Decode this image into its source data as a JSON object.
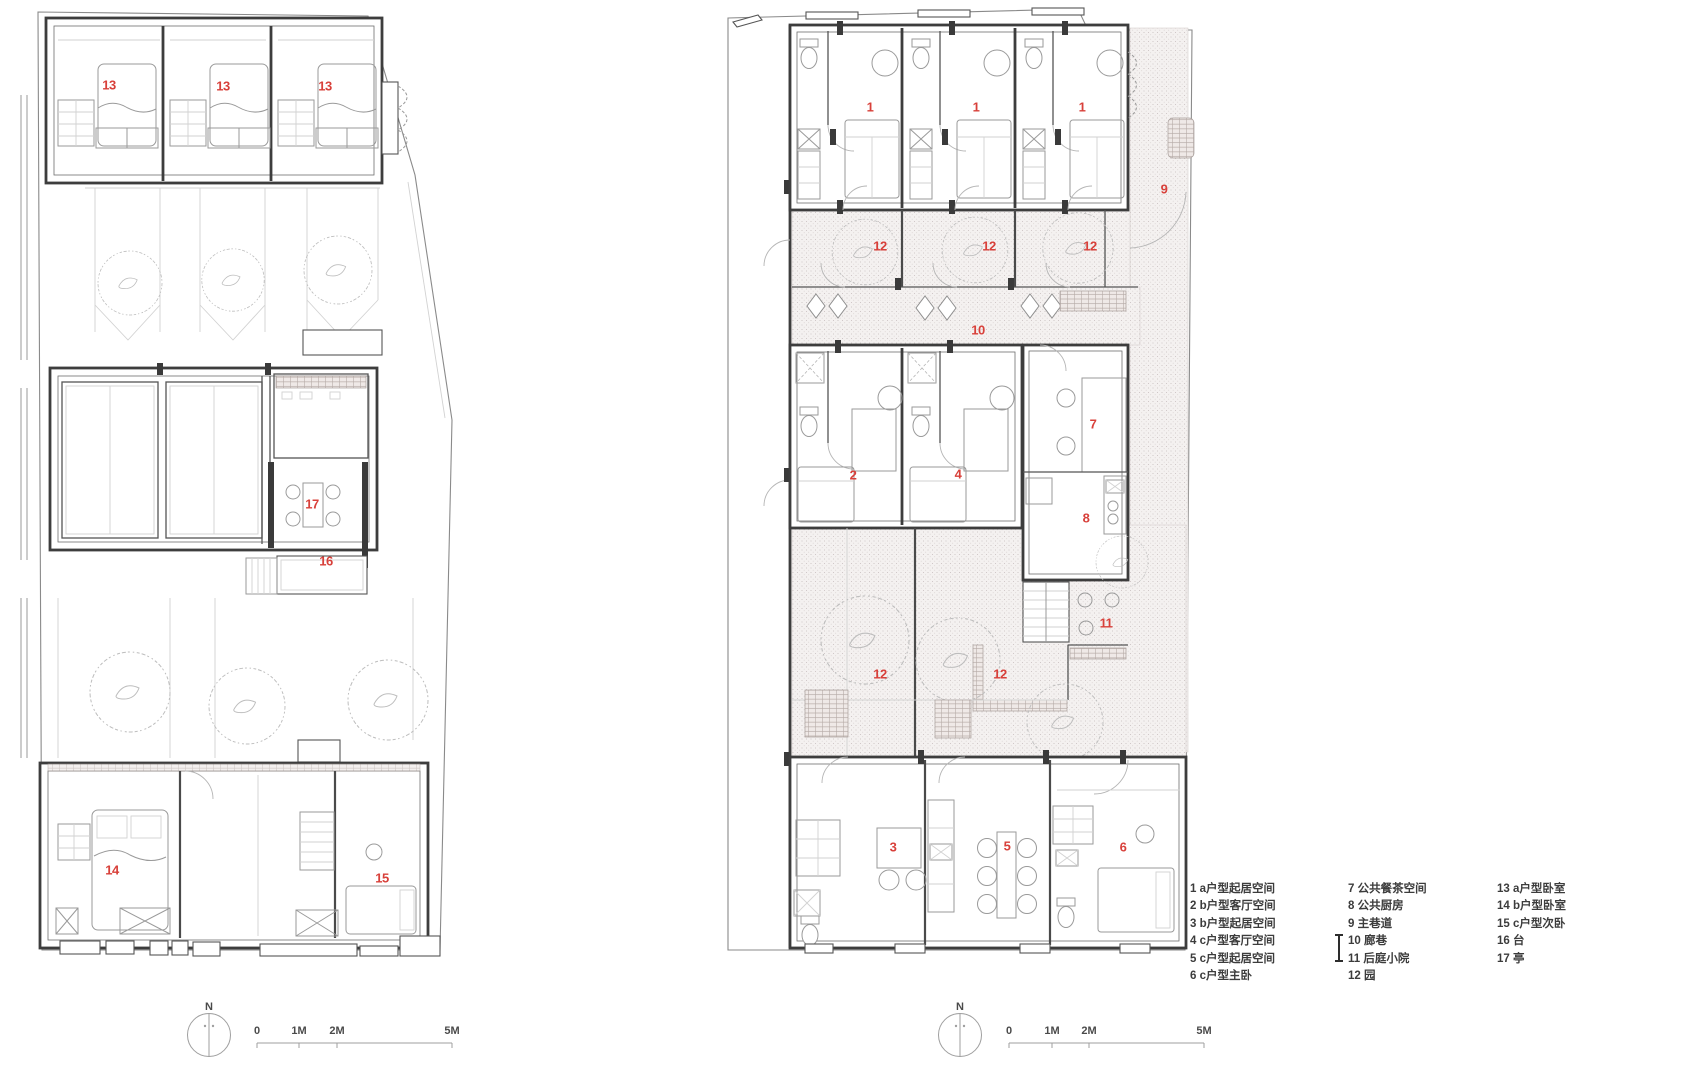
{
  "colors": {
    "label_red": "#d8403a",
    "wall_dark": "#3d3d3d",
    "line_mid": "#9a9a9a",
    "stipple_dot": "#c7bfbe",
    "anno_gray": "#4a4a4a"
  },
  "legend": {
    "columns": [
      {
        "items": [
          {
            "n": "1",
            "t": "a户型起居空间"
          },
          {
            "n": "2",
            "t": "b户型客厅空间"
          },
          {
            "n": "3",
            "t": "b户型起居空间"
          },
          {
            "n": "4",
            "t": "c户型客厅空间"
          },
          {
            "n": "5",
            "t": "c户型起居空间"
          },
          {
            "n": "6",
            "t": "c户型主卧"
          }
        ]
      },
      {
        "items": [
          {
            "n": "7",
            "t": "公共餐茶空间"
          },
          {
            "n": "8",
            "t": "公共厨房"
          },
          {
            "n": "9",
            "t": "主巷道"
          },
          {
            "n": "10",
            "t": "廊巷"
          },
          {
            "n": "11",
            "t": "后庭小院"
          },
          {
            "n": "12",
            "t": "园"
          }
        ]
      },
      {
        "items": [
          {
            "n": "13",
            "t": "a户型卧室"
          },
          {
            "n": "14",
            "t": "b户型卧室"
          },
          {
            "n": "15",
            "t": "c户型次卧"
          },
          {
            "n": "16",
            "t": "台"
          },
          {
            "n": "17",
            "t": "亭"
          }
        ]
      }
    ]
  },
  "plans": {
    "left": {
      "room_labels": [
        {
          "t": "13",
          "x": 109,
          "y": 86
        },
        {
          "t": "13",
          "x": 223,
          "y": 87
        },
        {
          "t": "13",
          "x": 325,
          "y": 87
        },
        {
          "t": "17",
          "x": 312,
          "y": 505
        },
        {
          "t": "16",
          "x": 326,
          "y": 562
        },
        {
          "t": "14",
          "x": 112,
          "y": 871
        },
        {
          "t": "15",
          "x": 382,
          "y": 879
        }
      ],
      "annotations": [
        {
          "t": "N",
          "x": 209,
          "y": 1007
        },
        {
          "t": "0",
          "x": 257,
          "y": 1031
        },
        {
          "t": "1M",
          "x": 299,
          "y": 1031
        },
        {
          "t": "2M",
          "x": 337,
          "y": 1031
        },
        {
          "t": "5M",
          "x": 452,
          "y": 1031
        }
      ]
    },
    "right": {
      "room_labels": [
        {
          "t": "1",
          "x": 870,
          "y": 108
        },
        {
          "t": "1",
          "x": 976,
          "y": 108
        },
        {
          "t": "1",
          "x": 1082,
          "y": 108
        },
        {
          "t": "9",
          "x": 1164,
          "y": 190
        },
        {
          "t": "12",
          "x": 880,
          "y": 247
        },
        {
          "t": "12",
          "x": 989,
          "y": 247
        },
        {
          "t": "12",
          "x": 1090,
          "y": 247
        },
        {
          "t": "10",
          "x": 978,
          "y": 331
        },
        {
          "t": "2",
          "x": 853,
          "y": 476
        },
        {
          "t": "4",
          "x": 958,
          "y": 475
        },
        {
          "t": "7",
          "x": 1093,
          "y": 425
        },
        {
          "t": "8",
          "x": 1086,
          "y": 519
        },
        {
          "t": "11",
          "x": 1106,
          "y": 624
        },
        {
          "t": "12",
          "x": 880,
          "y": 675
        },
        {
          "t": "12",
          "x": 1000,
          "y": 675
        },
        {
          "t": "3",
          "x": 893,
          "y": 848
        },
        {
          "t": "5",
          "x": 1007,
          "y": 847
        },
        {
          "t": "6",
          "x": 1123,
          "y": 848
        }
      ],
      "annotations": [
        {
          "t": "N",
          "x": 960,
          "y": 1007
        },
        {
          "t": "0",
          "x": 1009,
          "y": 1031
        },
        {
          "t": "1M",
          "x": 1052,
          "y": 1031
        },
        {
          "t": "2M",
          "x": 1089,
          "y": 1031
        },
        {
          "t": "5M",
          "x": 1204,
          "y": 1031
        }
      ]
    }
  }
}
